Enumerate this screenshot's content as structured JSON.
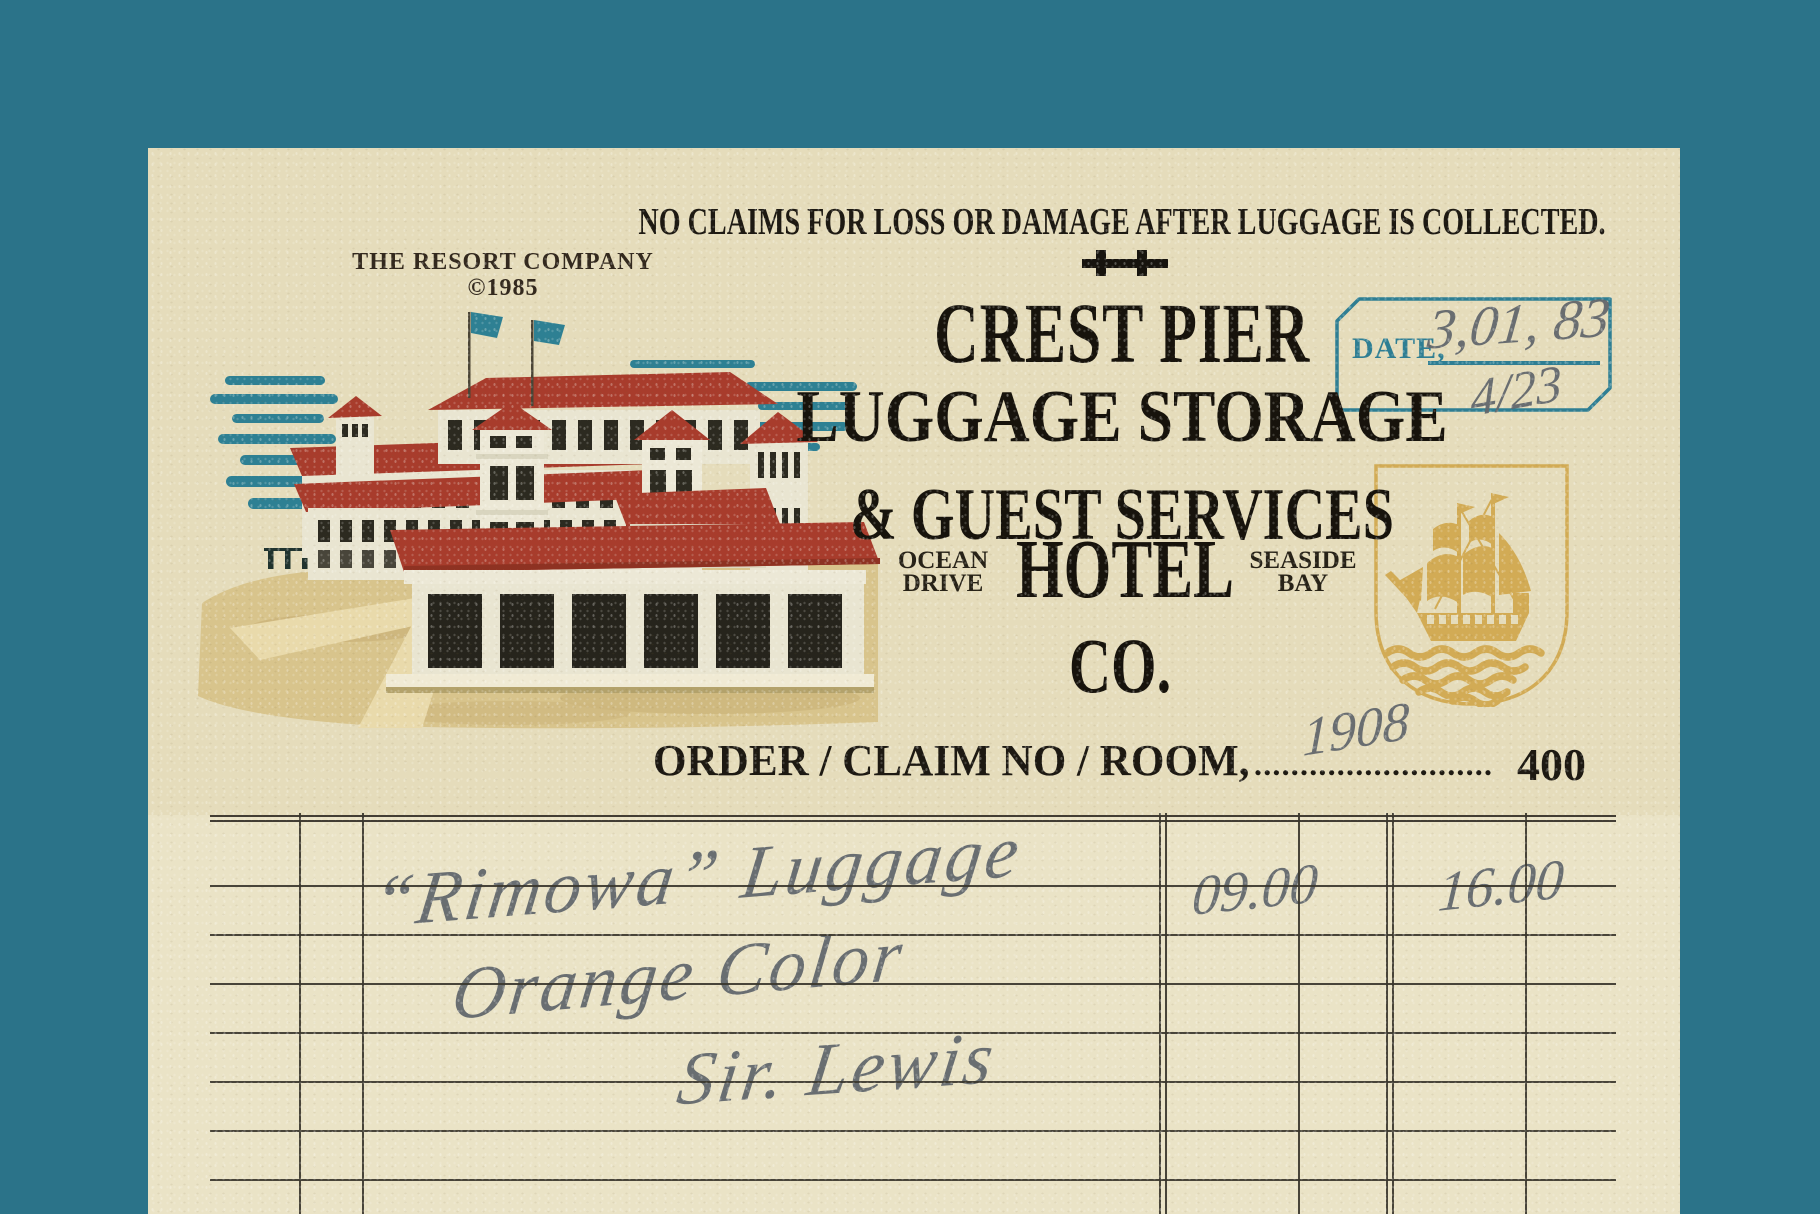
{
  "header": {
    "resort_company": "THE RESORT COMPANY",
    "copyright": "©1985",
    "no_claims": "NO CLAIMS FOR LOSS OR DAMAGE AFTER LUGGAGE IS COLLECTED.",
    "title": "CREST PIER",
    "subtitle_line1": "LUGGAGE STORAGE",
    "subtitle_line2": "& GUEST SERVICES",
    "address_left_line1": "OCEAN",
    "address_left_line2": "DRIVE",
    "hotel_word": "HOTEL",
    "address_right_line1": "SEASIDE",
    "address_right_line2": "BAY",
    "co_word": "CO."
  },
  "date_stamp": {
    "label": "DATE,",
    "handwritten_date": "3,01, 83",
    "handwritten_date_secondary": "4/23"
  },
  "order_row": {
    "label": "ORDER / CLAIM NO / ROOM,",
    "dots": "..........................",
    "handwritten_claim_no": "1908",
    "room_number": "400"
  },
  "ledger": {
    "rows": [
      {
        "description": "“Rimowa” Luggage",
        "amount_a": "09.00",
        "amount_b": "16.00"
      },
      {
        "description": "Orange Color",
        "amount_a": "",
        "amount_b": ""
      },
      {
        "description": "Sir. Lewis",
        "amount_a": "",
        "amount_b": ""
      }
    ]
  },
  "emblems": {
    "ship": "sailing-ship-shield-emblem",
    "divider": "double-cross-rule",
    "illustration": "pier-pavilion-hotel-illustration"
  },
  "colors": {
    "background": "#2b7389",
    "paper_header": "#e5dcbb",
    "paper_ledger": "#eae3c6",
    "stamp_teal": "#2e7e93",
    "emblem_gold": "#d2ab55",
    "ink": "#1d1912",
    "handwriting_gray": "#63686d",
    "roof_red": "#a83c2c"
  }
}
